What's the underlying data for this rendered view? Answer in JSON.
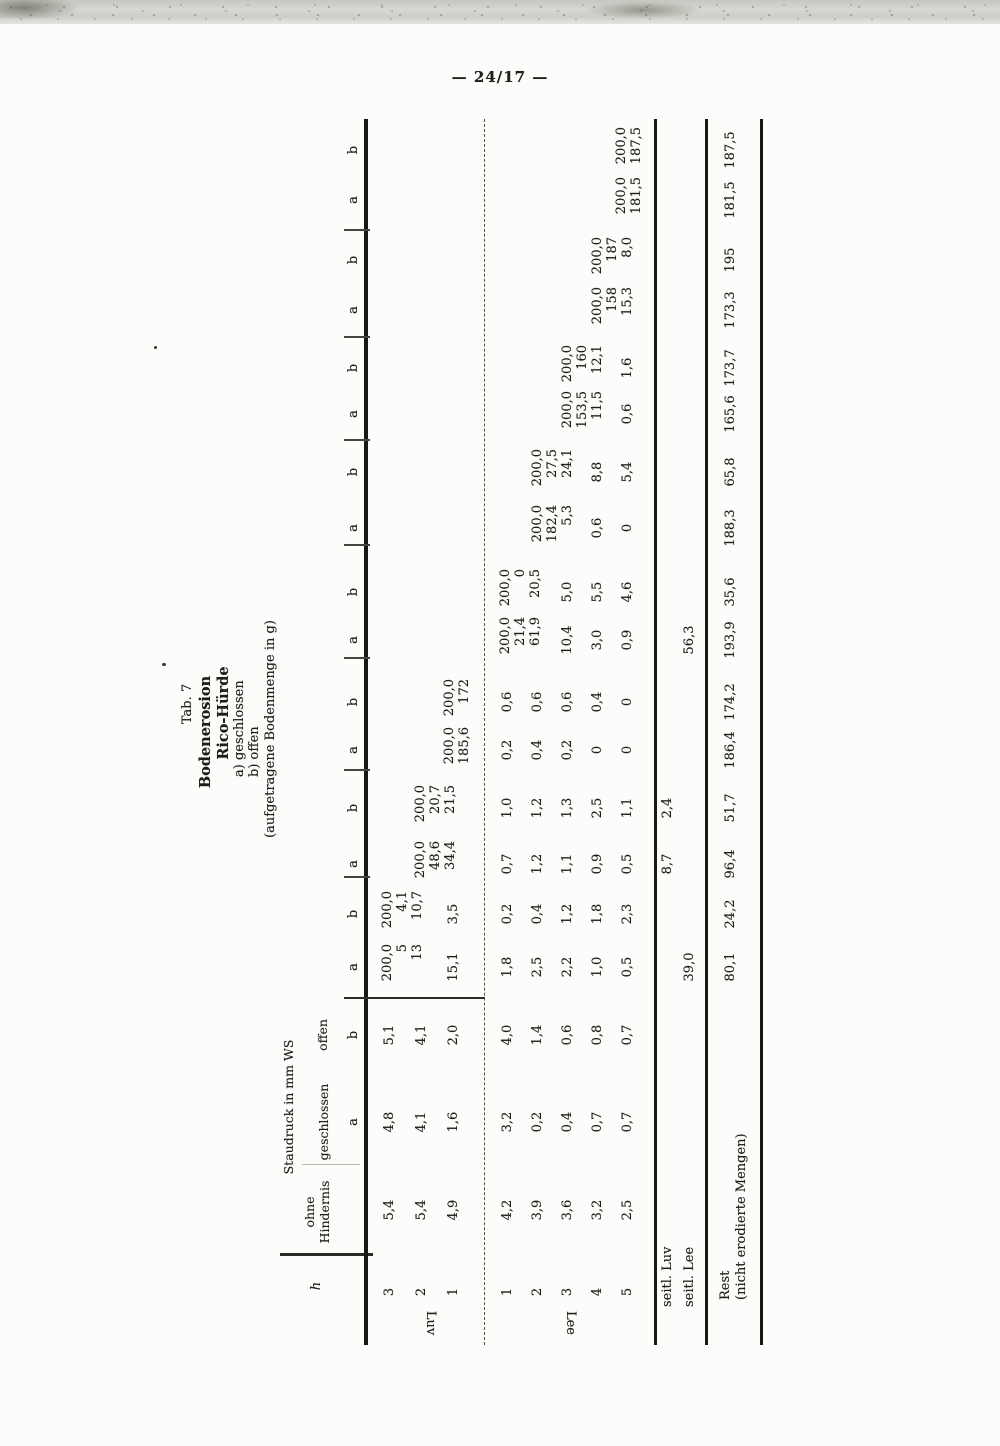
{
  "page": {
    "number": "— 24/17 —"
  },
  "title": {
    "tab": "Tab. 7",
    "line1": "Bodenerosion",
    "line2": "Rico-Hürde",
    "legend_a": "a) geschlossen",
    "legend_b": "b) offen",
    "unit": "(aufgetragene Bodenmenge in g)"
  },
  "table": {
    "header": {
      "h": "h",
      "ohne_line1": "ohne",
      "ohne_line2": "Hindernis",
      "staudruck": "Staudruck in mm WS",
      "geschlossen": "geschlossen",
      "offen": "offen"
    },
    "row_groups": {
      "luv": "Luv",
      "lee": "Lee"
    },
    "side_rows": {
      "seitl_luv": "seitl. Luv",
      "seitl_lee": "seitl. Lee",
      "rest": "Rest",
      "rest_note": "(nicht erodierte Mengen)"
    },
    "columns": [
      {
        "id": "h",
        "cells": {
          "luv3": "3",
          "luv2": "2",
          "luv1": "1",
          "lee1": "1",
          "lee2": "2",
          "lee3": "3",
          "lee4": "4",
          "lee5": "5"
        }
      },
      {
        "id": "ohne",
        "cells": {
          "luv3": "5,4",
          "luv2": "5,4",
          "luv1": "4,9",
          "lee1": "4,2",
          "lee2": "3,9",
          "lee3": "3,6",
          "lee4": "3,2",
          "lee5": "2,5"
        }
      },
      {
        "id": "ga",
        "letter": "a",
        "cells": {
          "luv3": "4,8",
          "luv2": "4,1",
          "luv1": "1,6",
          "lee1": "3,2",
          "lee2": "0,2",
          "lee3": "0,4",
          "lee4": "0,7",
          "lee5": "0,7"
        }
      },
      {
        "id": "ob",
        "letter": "b",
        "cells": {
          "luv3": "5,1",
          "luv2": "4,1",
          "luv1": "2,0",
          "lee1": "4,0",
          "lee2": "1,4",
          "lee3": "0,6",
          "lee4": "0,8",
          "lee5": "0,7"
        }
      },
      {
        "id": "g1a",
        "letter": "a",
        "stack": [
          "200,0",
          "5",
          "13"
        ],
        "cells": {
          "luv1": "15,1",
          "lee1": "1,8",
          "lee2": "2,5",
          "lee3": "2,2",
          "lee4": "1,0",
          "lee5": "0,5",
          "seitl_lee": "39,0",
          "rest": "80,1"
        }
      },
      {
        "id": "g1b",
        "letter": "b",
        "stack": [
          "200,0",
          "4,1",
          "10,7"
        ],
        "cells": {
          "luv1": "3,5",
          "lee1": "0,2",
          "lee2": "0,4",
          "lee3": "1,2",
          "lee4": "1,8",
          "lee5": "2,3",
          "rest": "24,2"
        }
      },
      {
        "id": "g2a",
        "letter": "a",
        "stack": [
          "200,0",
          "48,6",
          "34,4"
        ],
        "cells": {
          "lee1": "0,7",
          "lee2": "1,2",
          "lee3": "1,1",
          "lee4": "0,9",
          "lee5": "0,5",
          "seitl_luv": "8,7",
          "rest": "96,4"
        }
      },
      {
        "id": "g2b",
        "letter": "b",
        "stack": [
          "200,0",
          "20,7",
          "21,5"
        ],
        "cells": {
          "lee1": "1,0",
          "lee2": "1,2",
          "lee3": "1,3",
          "lee4": "2,5",
          "lee5": "1,1",
          "seitl_luv": "2,4",
          "rest": "51,7"
        }
      },
      {
        "id": "g3a",
        "letter": "a",
        "stack": [
          "200,0",
          "185,6"
        ],
        "cells": {
          "lee1": "0,2",
          "lee2": "0,4",
          "lee3": "0,2",
          "lee4": "0",
          "lee5": "0",
          "rest": "186,4"
        }
      },
      {
        "id": "g3b",
        "letter": "b",
        "stack": [
          "200,0",
          "172"
        ],
        "cells": {
          "lee1": "0,6",
          "lee2": "0,6",
          "lee3": "0,6",
          "lee4": "0,4",
          "lee5": "0",
          "rest": "174,2"
        }
      },
      {
        "id": "g4a",
        "letter": "a",
        "stack": [
          "200,0",
          "21,4",
          "61,9"
        ],
        "cells": {
          "lee3": "10,4",
          "lee4": "3,0",
          "lee5": "0,9",
          "seitl_lee": "56,3",
          "rest": "193,9"
        }
      },
      {
        "id": "g4b",
        "letter": "b",
        "stack": [
          "200,0",
          "0",
          "20,5"
        ],
        "cells": {
          "lee3": "5,0",
          "lee4": "5,5",
          "lee5": "4,6",
          "rest": "35,6"
        }
      },
      {
        "id": "g5a",
        "letter": "a",
        "stack": [
          "200,0",
          "182,4",
          "5,3"
        ],
        "cells": {
          "lee4": "0,6",
          "lee5": "0",
          "rest": "188,3"
        }
      },
      {
        "id": "g5b",
        "letter": "b",
        "stack": [
          "200,0",
          "27,5",
          "24,1"
        ],
        "cells": {
          "lee4": "8,8",
          "lee5": "5,4",
          "rest": "65,8"
        }
      },
      {
        "id": "g6a",
        "letter": "a",
        "stack": [
          "200,0",
          "153,5",
          "11,5"
        ],
        "cells": {
          "lee5": "0,6",
          "rest": "165,6"
        }
      },
      {
        "id": "g6b",
        "letter": "b",
        "stack": [
          "200,0",
          "160",
          "12,1"
        ],
        "cells": {
          "lee5": "1,6",
          "rest": "173,7"
        }
      },
      {
        "id": "g7a",
        "letter": "a",
        "stack": [
          "200,0",
          "158",
          "15,3"
        ],
        "cells": {
          "rest": "173,3"
        }
      },
      {
        "id": "g7b",
        "letter": "b",
        "stack": [
          "200,0",
          "187",
          "8,0"
        ],
        "cells": {
          "rest": "195"
        }
      },
      {
        "id": "g8a",
        "letter": "a",
        "stack": [
          "200,0",
          "181,5"
        ],
        "cells": {
          "rest": "181,5"
        }
      },
      {
        "id": "g8b",
        "letter": "b",
        "stack": [
          "200,0",
          "187,5"
        ],
        "cells": {
          "rest": "187,5"
        }
      }
    ]
  }
}
